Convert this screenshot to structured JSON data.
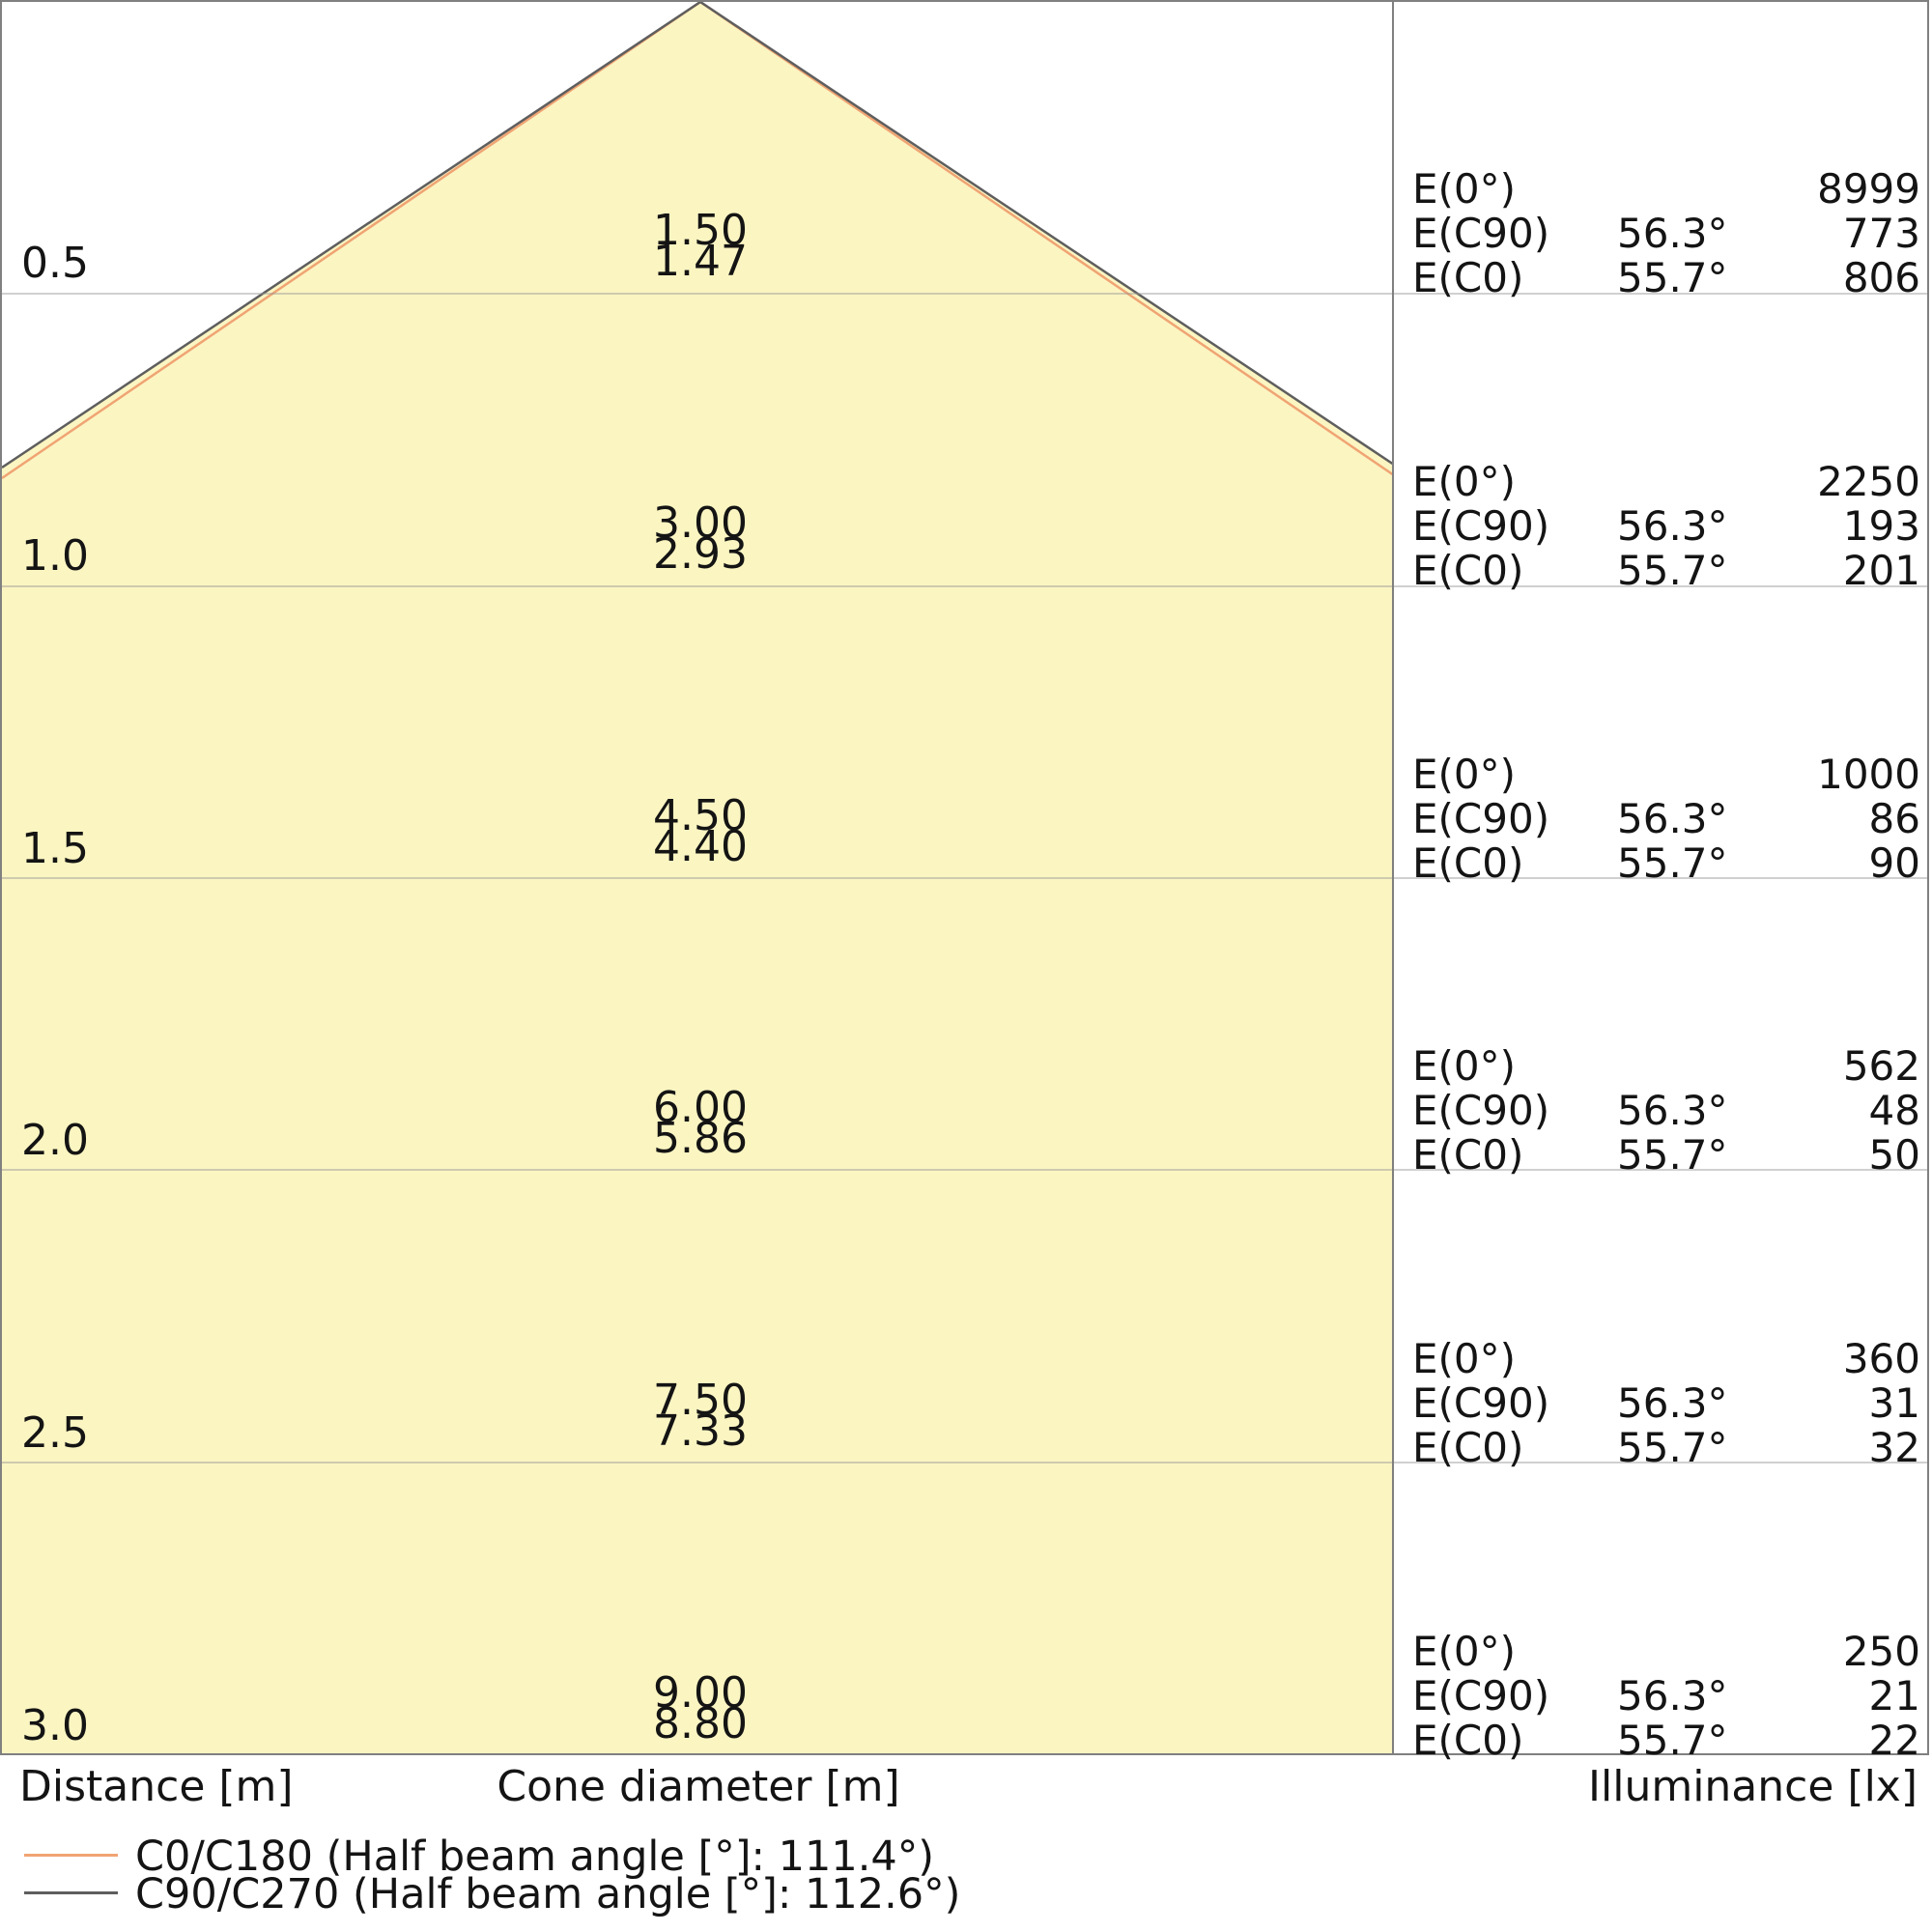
{
  "colors": {
    "cone_fill": "#fbf5c2",
    "c0_line": "#f0a473",
    "c90_line": "#5e5e5e",
    "grid": "#c8c8c8",
    "border": "#808080"
  },
  "axis_labels": {
    "distance": "Distance [m]",
    "cone_diameter": "Cone diameter [m]",
    "illuminance": "Illuminance [lx]"
  },
  "legend": {
    "items": [
      {
        "label": "C0/C180 (Half beam angle [°]: 111.4°)",
        "color": "#f0a473"
      },
      {
        "label": "C90/C270 (Half beam angle [°]: 112.6°)",
        "color": "#5e5e5e"
      }
    ]
  },
  "chart_data": {
    "type": "cone-diagram",
    "title": "Luminaire light cone diagram",
    "distance_axis": {
      "label": "Distance [m]",
      "ticks": [
        0.5,
        1.0,
        1.5,
        2.0,
        2.5,
        3.0
      ],
      "range": [
        0,
        3.0
      ]
    },
    "cone_axis_label": "Cone diameter [m]",
    "illuminance_axis_label": "Illuminance [lx]",
    "series": [
      {
        "name": "C0/C180",
        "half_beam_angle_deg": 111.4,
        "half_angle_deg": 55.7,
        "color": "#f0a473",
        "cone_diameters_m": [
          1.47,
          2.93,
          4.4,
          5.86,
          7.33,
          8.8
        ],
        "illuminance_lx": [
          806,
          201,
          90,
          50,
          32,
          22
        ]
      },
      {
        "name": "C90/C270",
        "half_beam_angle_deg": 112.6,
        "half_angle_deg": 56.3,
        "color": "#5e5e5e",
        "cone_diameters_m": [
          1.5,
          3.0,
          4.5,
          6.0,
          7.5,
          9.0
        ],
        "illuminance_lx": [
          773,
          193,
          86,
          48,
          31,
          21
        ]
      }
    ],
    "e0_lx": [
      8999,
      2250,
      1000,
      562,
      360,
      250
    ],
    "rows": [
      {
        "distance": "0.5",
        "cone_top": "1.50",
        "cone_bottom": "1.47",
        "lines": [
          {
            "label": "E(0°)",
            "angle": "",
            "value": "8999"
          },
          {
            "label": "E(C90)",
            "angle": "56.3°",
            "value": "773"
          },
          {
            "label": "E(C0)",
            "angle": "55.7°",
            "value": "806"
          }
        ]
      },
      {
        "distance": "1.0",
        "cone_top": "3.00",
        "cone_bottom": "2.93",
        "lines": [
          {
            "label": "E(0°)",
            "angle": "",
            "value": "2250"
          },
          {
            "label": "E(C90)",
            "angle": "56.3°",
            "value": "193"
          },
          {
            "label": "E(C0)",
            "angle": "55.7°",
            "value": "201"
          }
        ]
      },
      {
        "distance": "1.5",
        "cone_top": "4.50",
        "cone_bottom": "4.40",
        "lines": [
          {
            "label": "E(0°)",
            "angle": "",
            "value": "1000"
          },
          {
            "label": "E(C90)",
            "angle": "56.3°",
            "value": "86"
          },
          {
            "label": "E(C0)",
            "angle": "55.7°",
            "value": "90"
          }
        ]
      },
      {
        "distance": "2.0",
        "cone_top": "6.00",
        "cone_bottom": "5.86",
        "lines": [
          {
            "label": "E(0°)",
            "angle": "",
            "value": "562"
          },
          {
            "label": "E(C90)",
            "angle": "56.3°",
            "value": "48"
          },
          {
            "label": "E(C0)",
            "angle": "55.7°",
            "value": "50"
          }
        ]
      },
      {
        "distance": "2.5",
        "cone_top": "7.50",
        "cone_bottom": "7.33",
        "lines": [
          {
            "label": "E(0°)",
            "angle": "",
            "value": "360"
          },
          {
            "label": "E(C90)",
            "angle": "56.3°",
            "value": "31"
          },
          {
            "label": "E(C0)",
            "angle": "55.7°",
            "value": "32"
          }
        ]
      },
      {
        "distance": "3.0",
        "cone_top": "9.00",
        "cone_bottom": "8.80",
        "lines": [
          {
            "label": "E(0°)",
            "angle": "",
            "value": "250"
          },
          {
            "label": "E(C90)",
            "angle": "56.3°",
            "value": "21"
          },
          {
            "label": "E(C0)",
            "angle": "55.7°",
            "value": "22"
          }
        ]
      }
    ]
  }
}
